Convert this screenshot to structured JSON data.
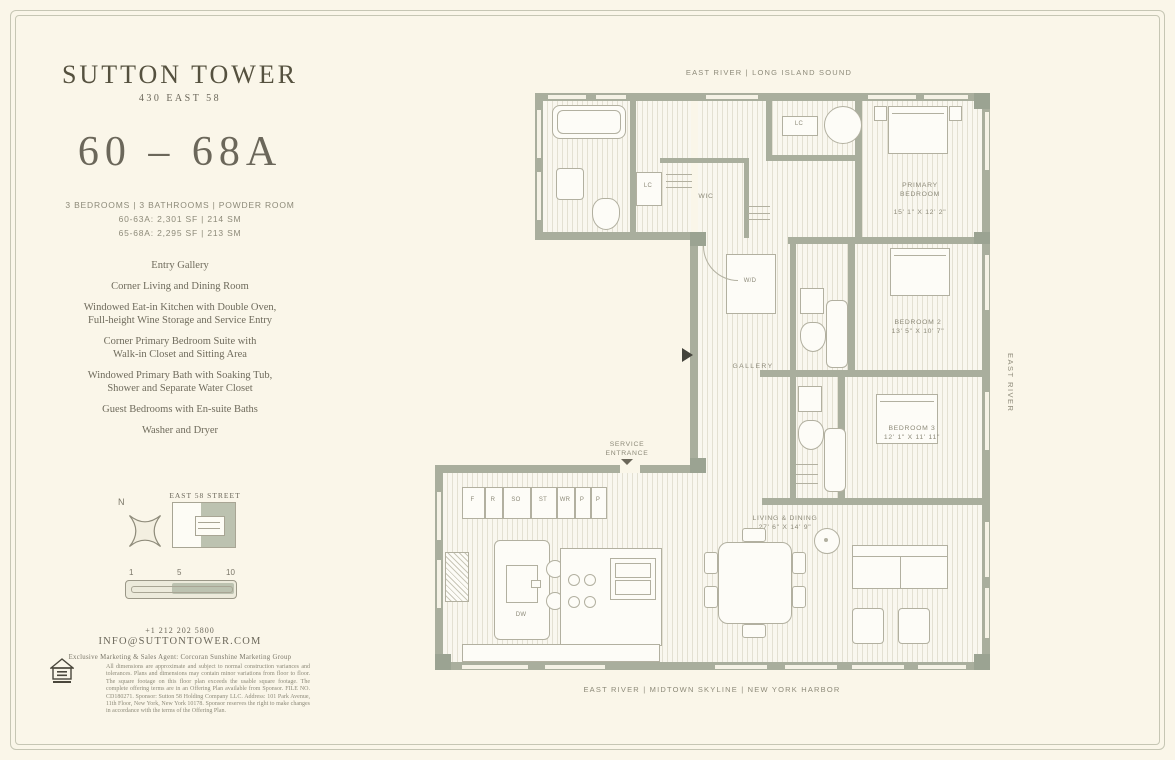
{
  "colors": {
    "background": "#faf6e9",
    "wall": "#a9ae9d",
    "ink": "#55513f",
    "label": "#8d8a79"
  },
  "brand": {
    "name": "SUTTON TOWER",
    "address": "430 EAST 58",
    "unit": "60 – 68A",
    "specs": [
      "3 BEDROOMS | 3 BATHROOMS | POWDER ROOM",
      "60-63A: 2,301 SF | 214 SM",
      "65-68A: 2,295 SF | 213 SM"
    ]
  },
  "features": [
    "Entry Gallery",
    "Corner Living and Dining Room",
    "Windowed Eat-in Kitchen with Double Oven,\nFull-height Wine Storage and Service Entry",
    "Corner Primary Bedroom Suite with\nWalk-in Closet and Sitting Area",
    "Windowed Primary Bath with Soaking Tub,\nShower and Separate Water Closet",
    "Guest Bedrooms with En-suite Baths",
    "Washer and Dryer"
  ],
  "keyplan": {
    "north": "N",
    "street": "EAST 58 STREET",
    "scale": [
      "1",
      "5",
      "10"
    ]
  },
  "contact": {
    "phone": "+1 212 202 5800",
    "email": "INFO@SUTTONTOWER.COM",
    "agent": "Exclusive Marketing & Sales Agent: Corcoran Sunshine Marketing Group"
  },
  "legal": {
    "text": "All dimensions are approximate and subject to normal construction variances and tolerances. Plans and dimensions may contain minor variations from floor to floor. The square footage on this floor plan exceeds the usable square footage. The complete offering terms are in an Offering Plan available from Sponsor. FILE NO. CD180271. Sponsor: Sutton 58 Holding Company LLC. Address: 101 Park Avenue, 11th Floor, New York, New York 10178. Sponsor reserves the right to make changes in accordance with the terms of the Offering Plan."
  },
  "plan": {
    "labels": {
      "top": "EAST RIVER | LONG ISLAND SOUND",
      "bottom": "EAST RIVER | MIDTOWN SKYLINE | NEW YORK HARBOR",
      "right": "EAST RIVER"
    },
    "service": "SERVICE\nENTRANCE",
    "rooms": {
      "primary": {
        "name": "PRIMARY\nBEDROOM",
        "dims": "15' 1\" X 12' 2\""
      },
      "bedroom2": {
        "name": "BEDROOM 2",
        "dims": "13' 5\" X 10' 7\""
      },
      "bedroom3": {
        "name": "BEDROOM 3",
        "dims": "12' 1\" X 11' 11\""
      },
      "living": {
        "name": "LIVING & DINING",
        "dims": "27' 6\" X 14' 9\""
      },
      "gallery": "GALLERY",
      "wic": "WIC",
      "wd": "W/D",
      "lc_bath": "LC",
      "lc_hall": "LC",
      "dw": "DW"
    },
    "closets": [
      "F",
      "R",
      "SO",
      "ST",
      "WR",
      "P",
      "P"
    ]
  }
}
